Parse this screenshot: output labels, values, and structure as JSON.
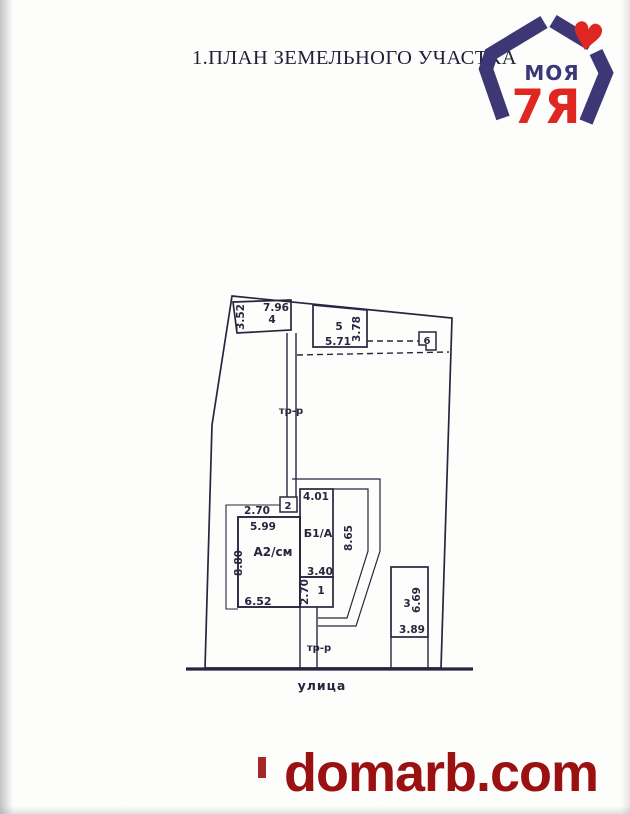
{
  "page": {
    "title": "1.ПЛАН ЗЕМЕЛЬНОГО УЧАСТКА",
    "watermark": "domarb.com"
  },
  "logo": {
    "word_top": "МОЯ",
    "word_main": "7Я",
    "heart": "♥",
    "navy": "#3e3776",
    "red": "#e02621"
  },
  "plan": {
    "ink": "#26263f",
    "street_label": "улица",
    "path_upper_label": "тр-р",
    "path_lower_label": "тр-р",
    "b4": {
      "label": "4",
      "dim_top": "7.96",
      "dim_left": "3.52"
    },
    "b5": {
      "label": "5",
      "dim_bottom": "5.71",
      "dim_right": "3.78"
    },
    "b6": {
      "label": "6"
    },
    "b2": {
      "label": "2"
    },
    "porch": {
      "dim_top": "2.70"
    },
    "house": {
      "label": "А2/см",
      "dim_top": "5.99",
      "dim_left": "8.80",
      "dim_bottom": "6.52"
    },
    "b1a": {
      "label": "Б1/А",
      "dim_top": "4.01",
      "dim_right": "8.65",
      "dim_bottom": "3.40"
    },
    "room1": {
      "label": "1",
      "dim_left": "2.70"
    },
    "b3": {
      "label": "3",
      "dim_right": "6.69",
      "dim_bottom": "3.89"
    }
  }
}
